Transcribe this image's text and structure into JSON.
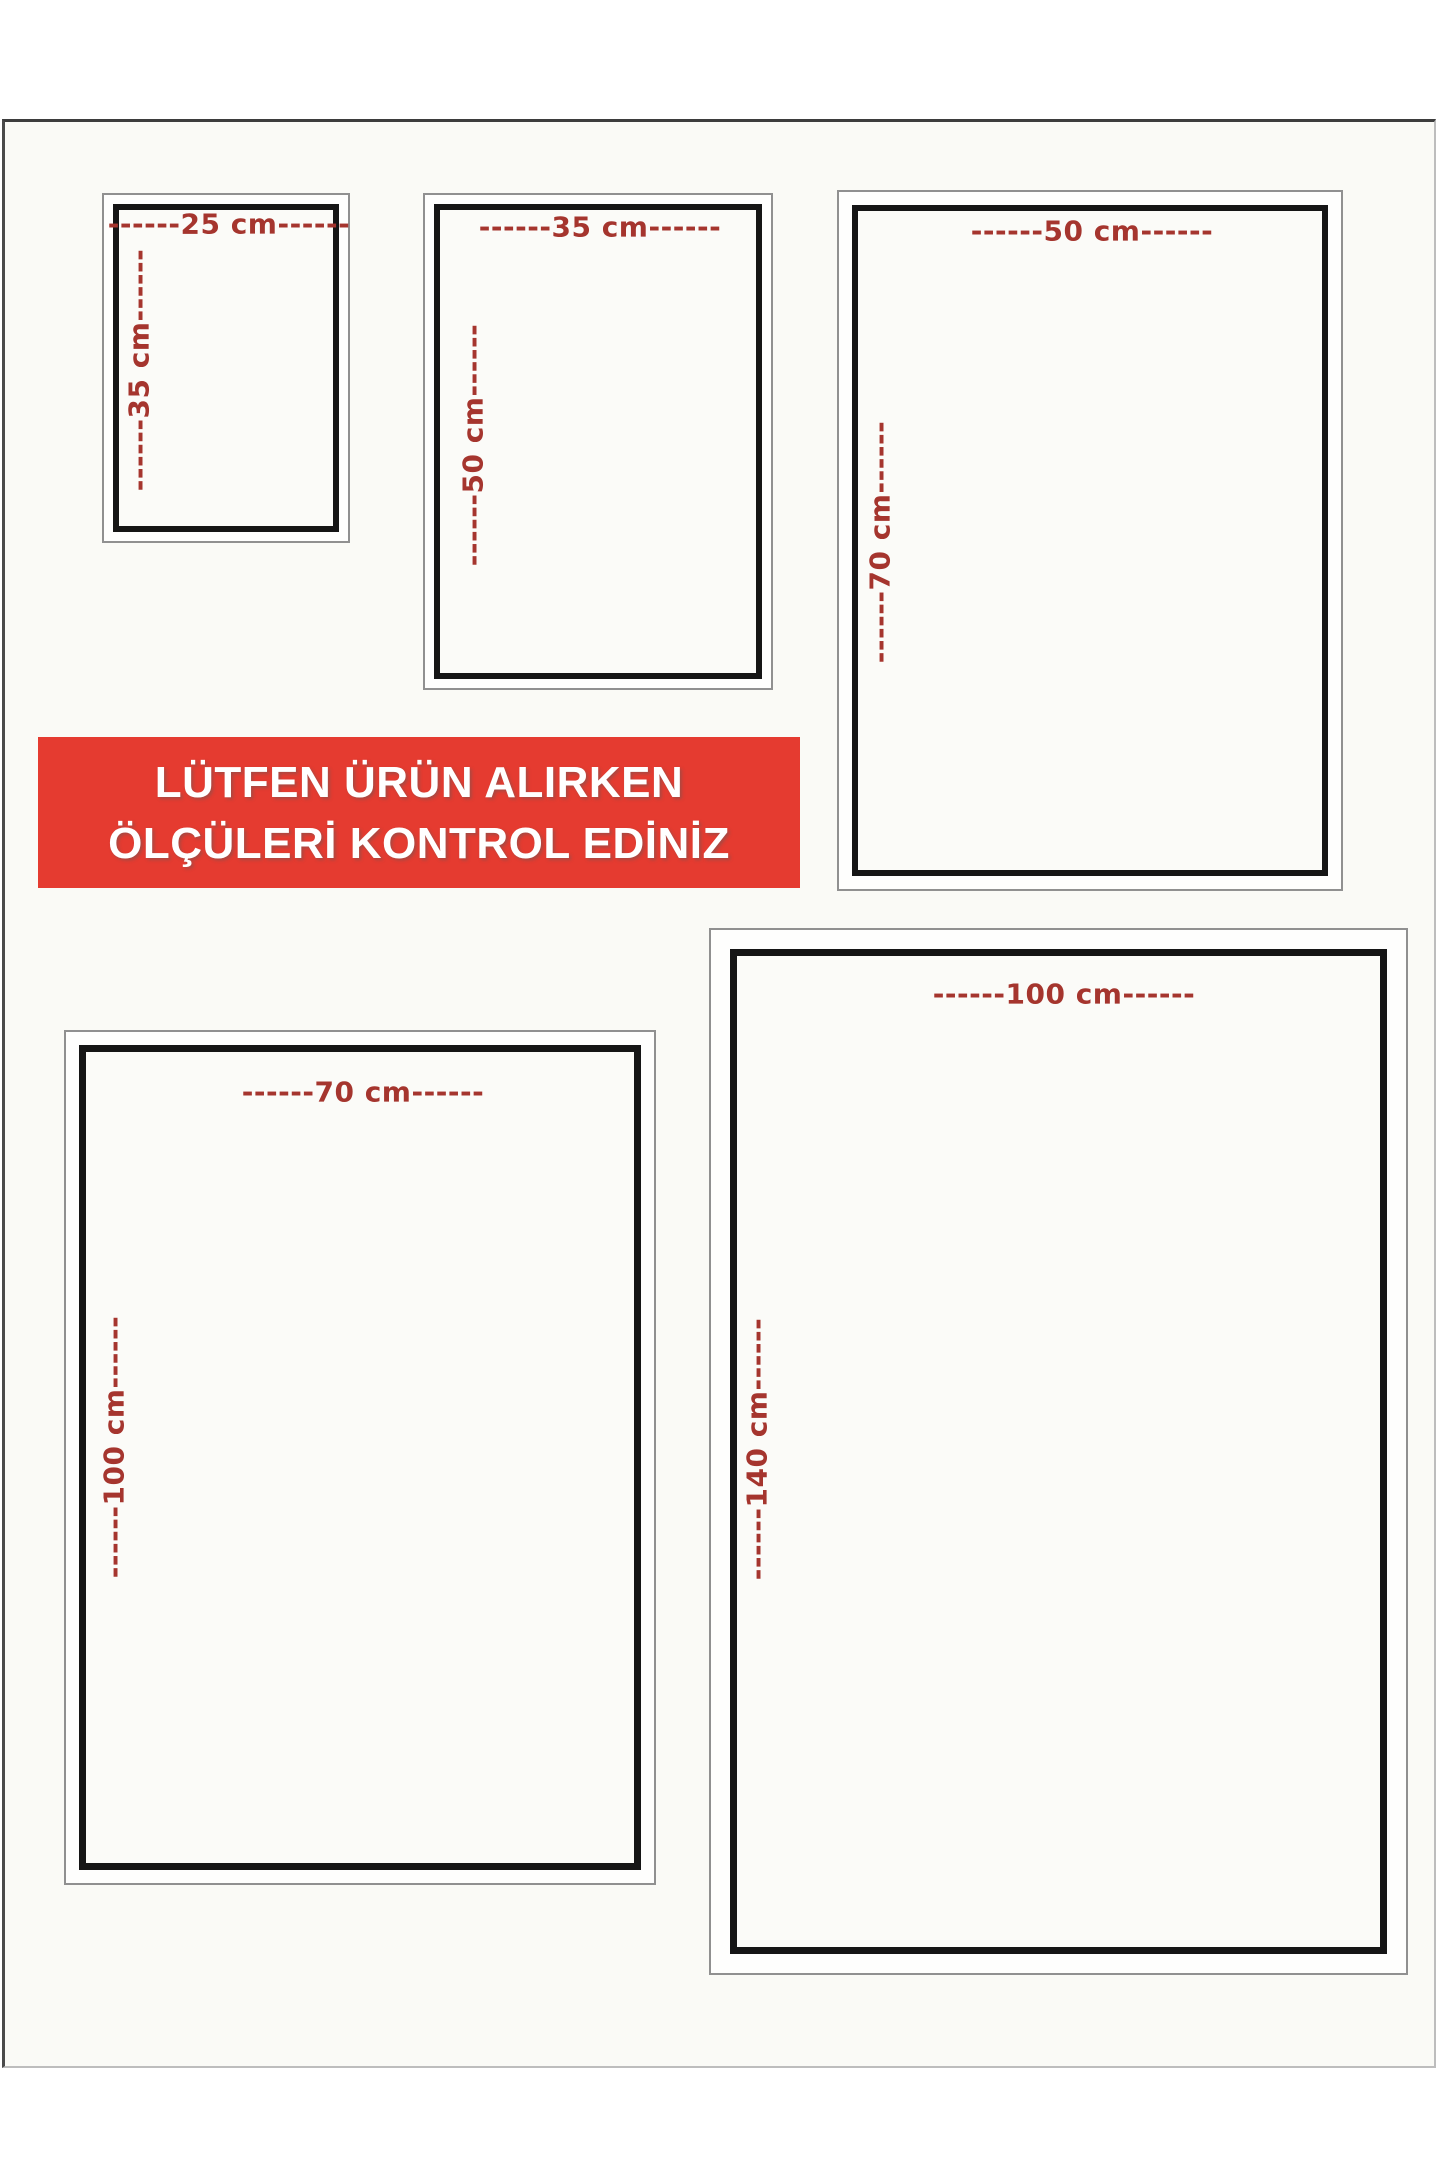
{
  "banner": {
    "line1": "LÜTFEN ÜRÜN ALIRKEN",
    "line2": "ÖLÇÜLERİ KONTROL EDİNİZ",
    "bg_color": "#e53b30",
    "text_color": "#ffffff"
  },
  "colors": {
    "label_red": "#a5352e",
    "border_black": "#151515",
    "frame_gray": "#909090",
    "sheet_background": "#fafaf6"
  },
  "sizes": [
    {
      "name": "25x35",
      "width_cm": 25,
      "height_cm": 35,
      "width_label": "------25 cm------",
      "height_label": "------35 cm------"
    },
    {
      "name": "35x50",
      "width_cm": 35,
      "height_cm": 50,
      "width_label": "------35 cm------",
      "height_label": "------50 cm------"
    },
    {
      "name": "50x70",
      "width_cm": 50,
      "height_cm": 70,
      "width_label": "------50 cm------",
      "height_label": "------70 cm------"
    },
    {
      "name": "70x100",
      "width_cm": 70,
      "height_cm": 100,
      "width_label": "------70 cm------",
      "height_label": "------100 cm------"
    },
    {
      "name": "100x140",
      "width_cm": 100,
      "height_cm": 140,
      "width_label": "------100 cm------",
      "height_label": "------140 cm------"
    }
  ]
}
